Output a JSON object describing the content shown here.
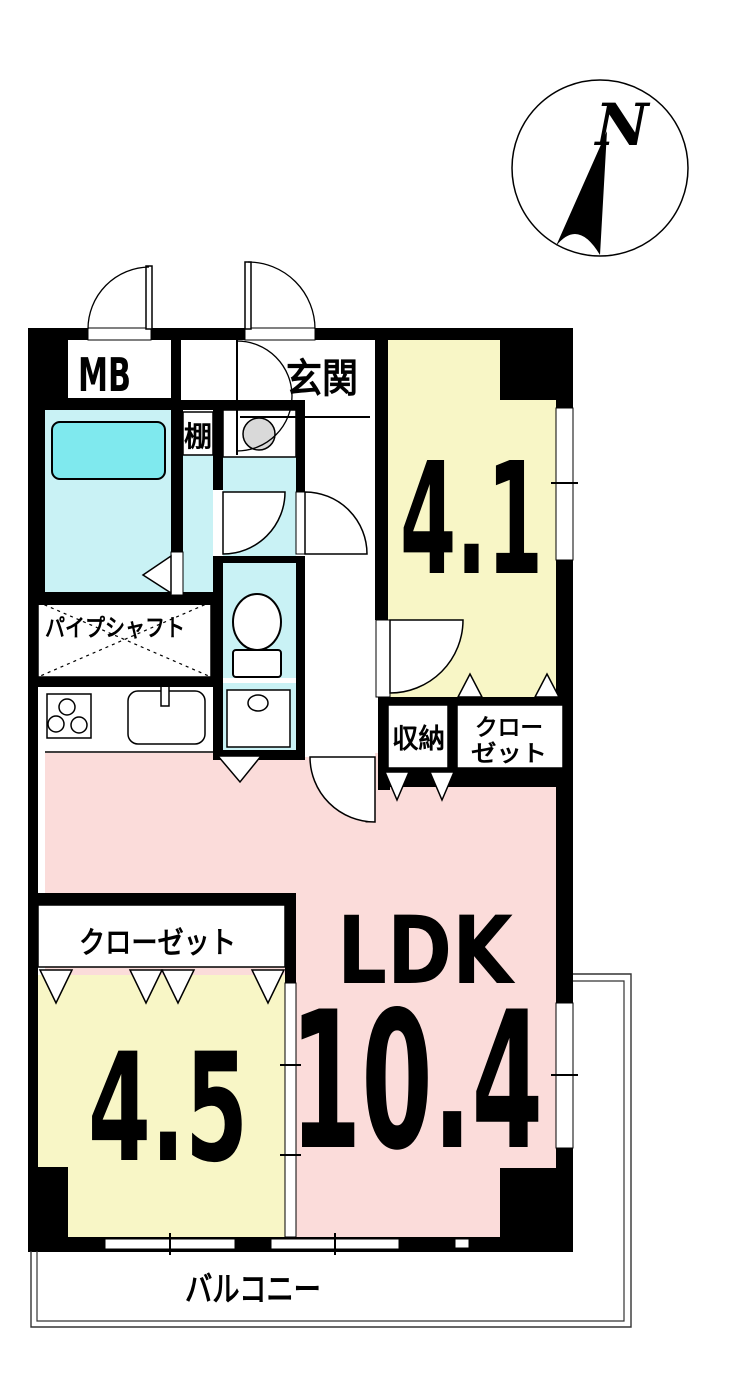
{
  "title": "apartment-floor-plan",
  "compass": {
    "north_label": "N"
  },
  "rooms": {
    "mb": "MB",
    "entrance": "玄関",
    "shelf": "棚",
    "pipe_shaft": "パイプシャフト",
    "storage": "収納",
    "closet_41_line1": "クロー",
    "closet_41_line2": "ゼット",
    "closet_45": "クローゼット",
    "room_41_size": "4.1",
    "room_45_size": "4.5",
    "ldk_label": "LDK",
    "ldk_size": "10.4",
    "balcony": "バルコニー"
  },
  "colors": {
    "wall": "#000000",
    "room_yellow": "#F8F6C6",
    "room_pink": "#FBDCDA",
    "wet_floor": "#C9F2F5",
    "bathtub": "#7FE9EE",
    "appliance_gray": "#D9D9D9"
  }
}
